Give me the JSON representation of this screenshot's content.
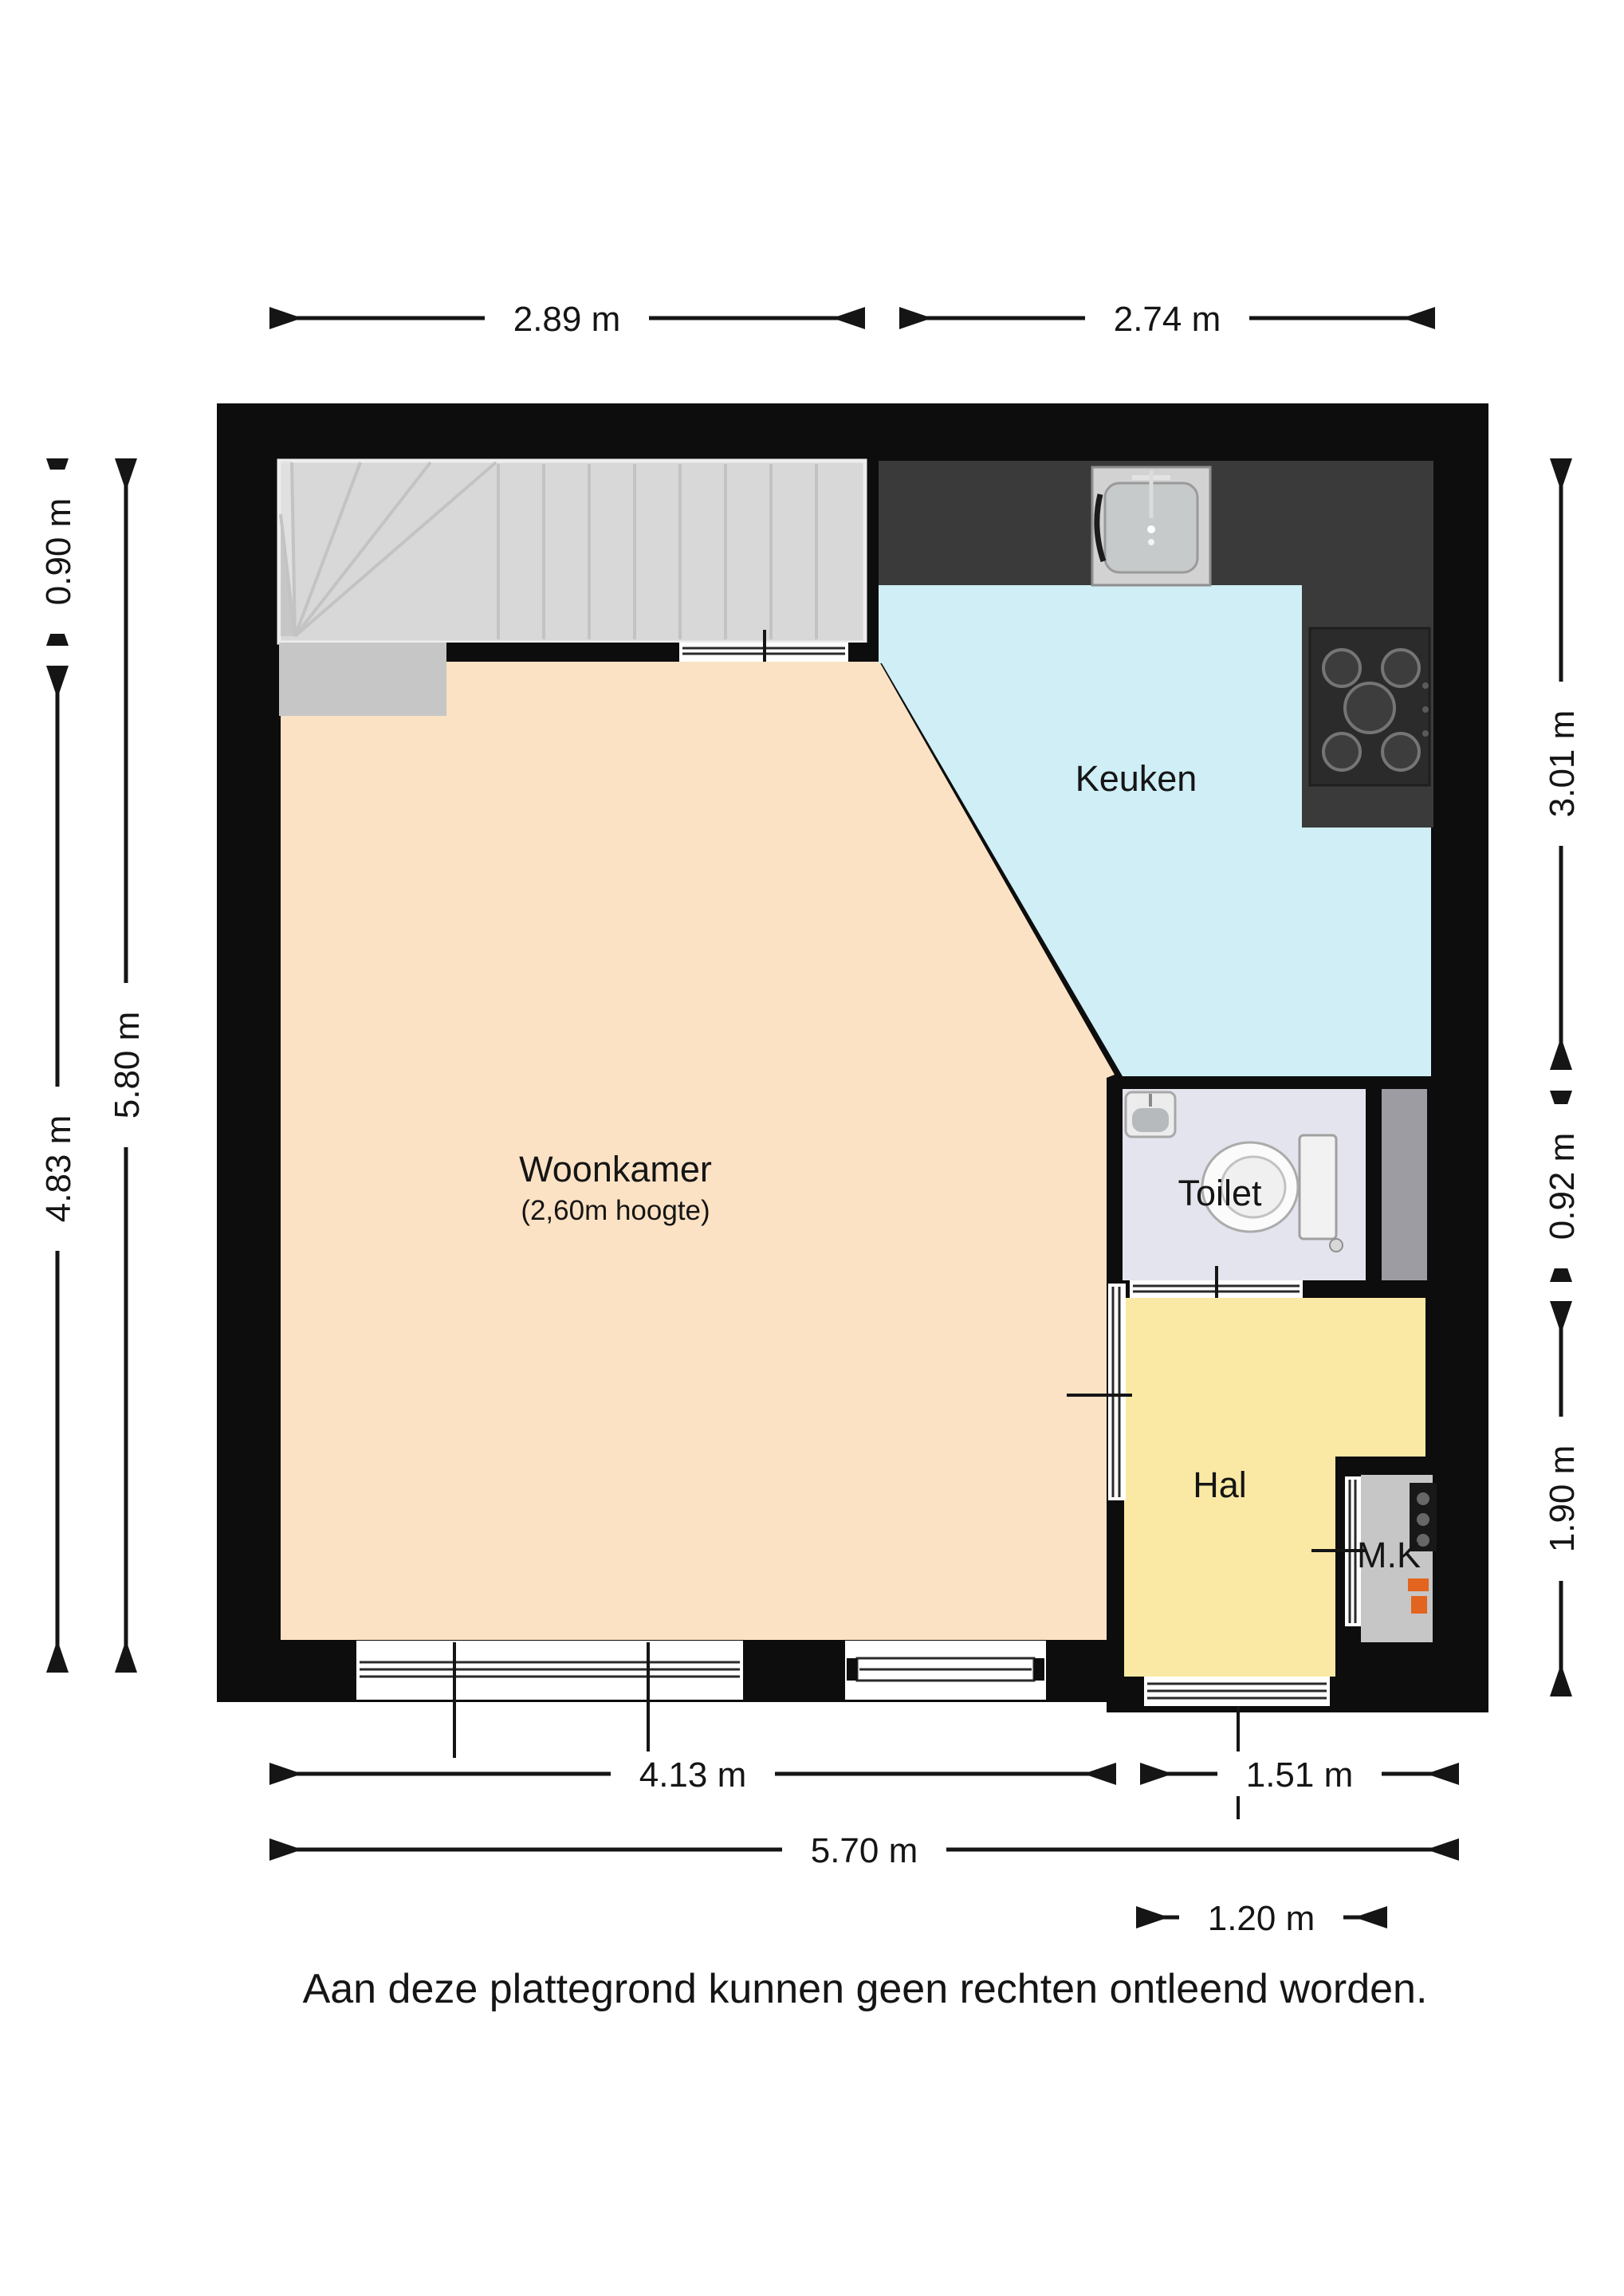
{
  "page": {
    "disclaimer": "Aan deze plattegrond kunnen geen rechten ontleend worden."
  },
  "rooms": {
    "woonkamer": {
      "label": "Woonkamer",
      "height_note": "(2,60m hoogte)"
    },
    "keuken": {
      "label": "Keuken"
    },
    "toilet": {
      "label": "Toilet"
    },
    "hal": {
      "label": "Hal"
    },
    "meterkast": {
      "label": "M.K"
    }
  },
  "dimensions": {
    "top_left": "2.89 m",
    "top_right": "2.74 m",
    "left_outer": "5.80 m",
    "left_top": "0.90 m",
    "left_bottom": "4.83 m",
    "right_top": "3.01 m",
    "right_middle": "0.92 m",
    "right_bottom": "1.90 m",
    "bottom_window": "4.13 m",
    "bottom_hal": "1.51 m",
    "bottom_total": "5.70 m",
    "bottom_door": "1.20 m"
  },
  "colors": {
    "wall": "#0d0d0d",
    "woonkamer_floor": "#fbe2c4",
    "keuken_floor": "#cfeef6",
    "hal_floor": "#fae9a4",
    "toilet_floor": "#e4e4ee",
    "stairs": "#d8d8d8",
    "counter": "#3a3a3a",
    "meter_accent": "#e2641f"
  }
}
